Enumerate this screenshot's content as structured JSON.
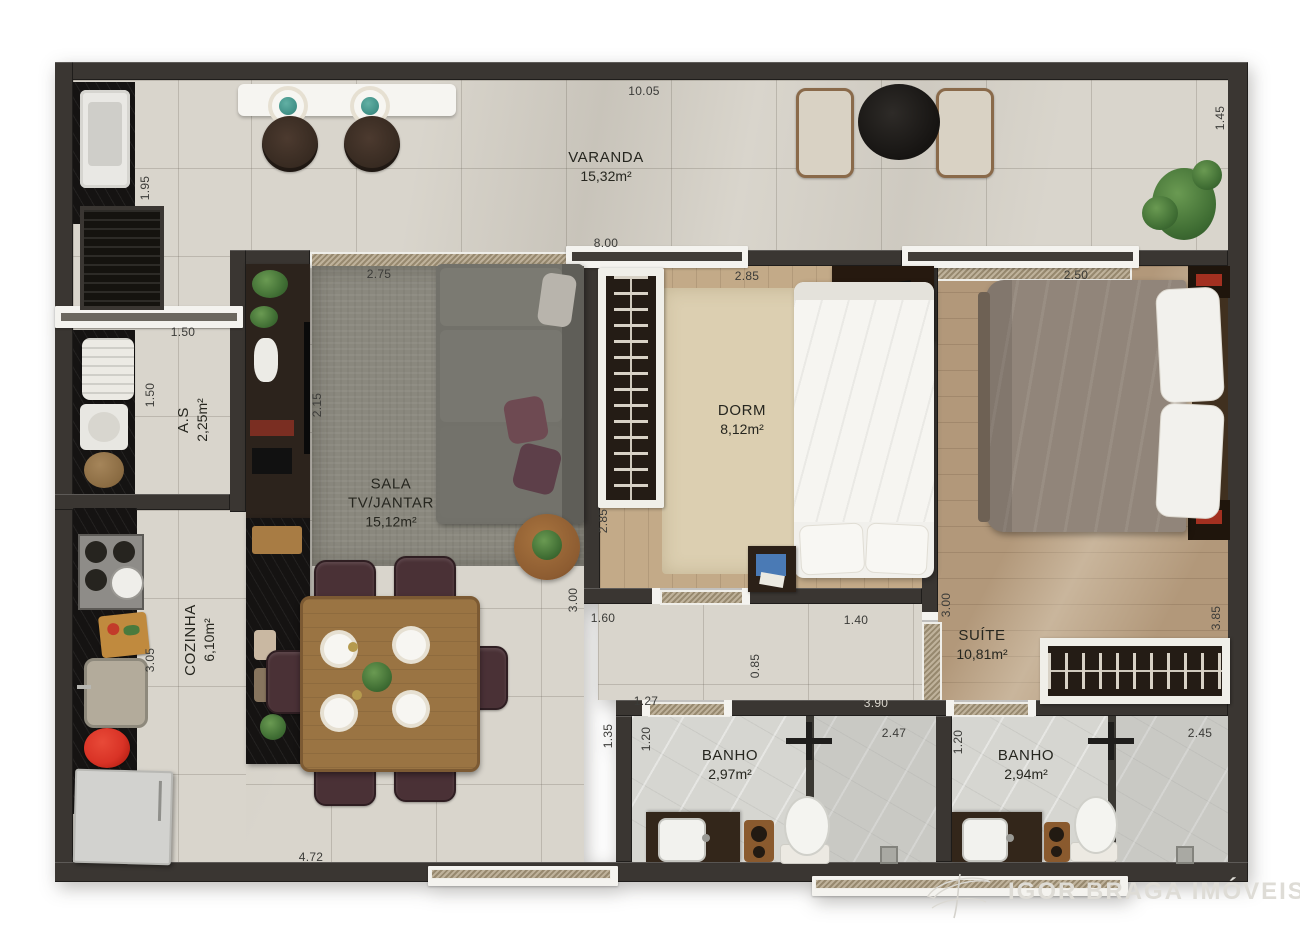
{
  "watermark": {
    "brand": "IGOR BRAGA IMÓVEIS",
    "logo": "igor-braga-monogram"
  },
  "rooms": {
    "varanda": {
      "name": "VARANDA",
      "area": "15,32m²"
    },
    "sala": {
      "name": "SALA TV/JANTAR",
      "area": "15,12m²"
    },
    "dorm": {
      "name": "DORM",
      "area": "8,12m²"
    },
    "suite": {
      "name": "SUÍTE",
      "area": "10,81m²"
    },
    "cozinha": {
      "name": "COZINHA",
      "area": "6,10m²"
    },
    "area_servico": {
      "name": "A.S",
      "area": "2,25m²"
    },
    "banho_1": {
      "name": "BANHO",
      "area": "2,97m²"
    },
    "banho_2": {
      "name": "BANHO",
      "area": "2,94m²"
    }
  },
  "dimensions": {
    "top_total": "10.05",
    "varanda_right_depth": "1.45",
    "varanda_left_depth": "1.95",
    "living_top_span": "8.00",
    "sala_top_width": "2.75",
    "dorm_top_width": "2.85",
    "suite_top_width": "2.50",
    "as_top_width": "1.50",
    "as_left_height": "1.50",
    "sala_left_height": "2.15",
    "dorm_left_height": "2.85",
    "dorm_wall_height": "3.00",
    "cozinha_left_height": "3.05",
    "sala_bottom_width": "1.60",
    "hall_height": "0.85",
    "hall_top_width": "1.40",
    "suite_left_height": "3.00",
    "suite_right_height": "3.85",
    "banho1_top_width": "1.27",
    "suite_bottom_width": "3.90",
    "banho1_wall_height": "1.35",
    "banho1_left_height": "1.20",
    "banho1_right_width": "2.47",
    "banho2_left_height": "1.20",
    "banho2_right_width": "2.45",
    "cozinha_bottom_width": "4.72"
  },
  "colors": {
    "wall": "#3a3632",
    "tile_floor": "#d9d5cc",
    "wood_dorm": "#c3aa88",
    "wood_suite": "#b2987a",
    "rug": "#8a887e",
    "counter_stone": "#151312",
    "accent_red": "#d93326",
    "plant_green": "#4a7a3d",
    "watermark_gray": "#dedcd6"
  }
}
